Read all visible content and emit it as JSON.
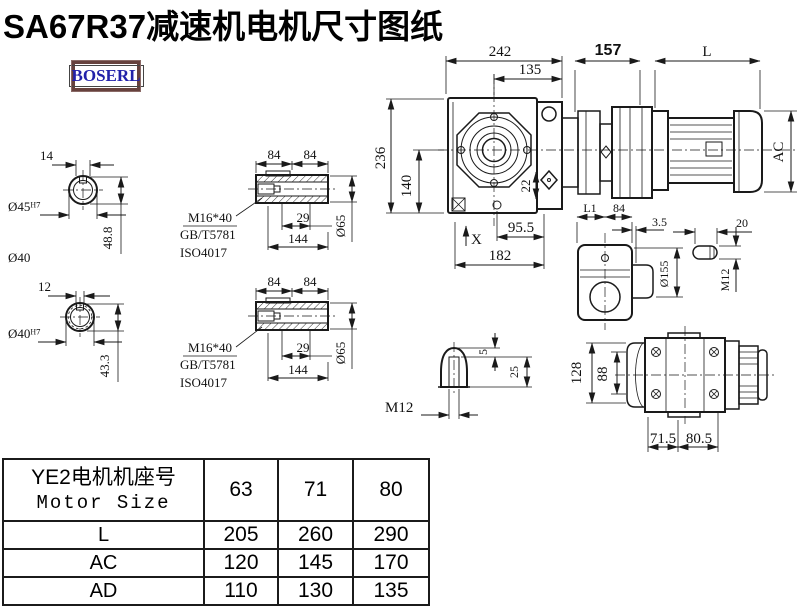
{
  "title": "SA67R37减速机电机尺寸图纸",
  "logo": {
    "text": "BOSERL",
    "text_color": "#2222aa",
    "border_color": "#66413d"
  },
  "colors": {
    "line": "#1a1a1a",
    "background": "#ffffff"
  },
  "drawing": {
    "shaft45": {
      "key_width": "14",
      "bore": "Ø45ᴴ⁷",
      "key_depth": "48.8",
      "outer_dia": "Ø40"
    },
    "shaft40": {
      "key_width": "12",
      "bore": "Ø40ᴴ⁷",
      "key_depth": "43.3"
    },
    "sleeve": {
      "len_a": "84",
      "len_b": "84",
      "bolt": "M16*40",
      "std1": "GB/T5781",
      "std2": "ISO4017",
      "depth": "29",
      "total_len": "144",
      "dia": "Ø65"
    },
    "front": {
      "width": "242",
      "center_to_right": "135",
      "height": "236",
      "center_to_bottom": "140",
      "plug": "22",
      "bolt_span": "95.5",
      "base": "182",
      "x_mark": "X"
    },
    "side": {
      "gear_len": "157",
      "motor_len": "L",
      "motor_dia": "AC"
    },
    "output": {
      "l1": "L1",
      "len84": "84",
      "offset": "3.5",
      "flange_dia": "Ø155",
      "key_len": "20",
      "thread": "M12"
    },
    "shaft_end": {
      "depth5": "5",
      "depth25": "25",
      "thread": "M12"
    },
    "bottom": {
      "height128": "128",
      "width88": "88",
      "foot_a": "71.5",
      "foot_b": "80.5"
    }
  },
  "table": {
    "header_cn": "YE2电机机座号",
    "header_en": "Motor Size",
    "sizes": [
      "63",
      "71",
      "80"
    ],
    "rows": [
      {
        "label": "L",
        "values": [
          "205",
          "260",
          "290"
        ]
      },
      {
        "label": "AC",
        "values": [
          "120",
          "145",
          "170"
        ]
      },
      {
        "label": "AD",
        "values": [
          "110",
          "130",
          "135"
        ]
      }
    ]
  }
}
